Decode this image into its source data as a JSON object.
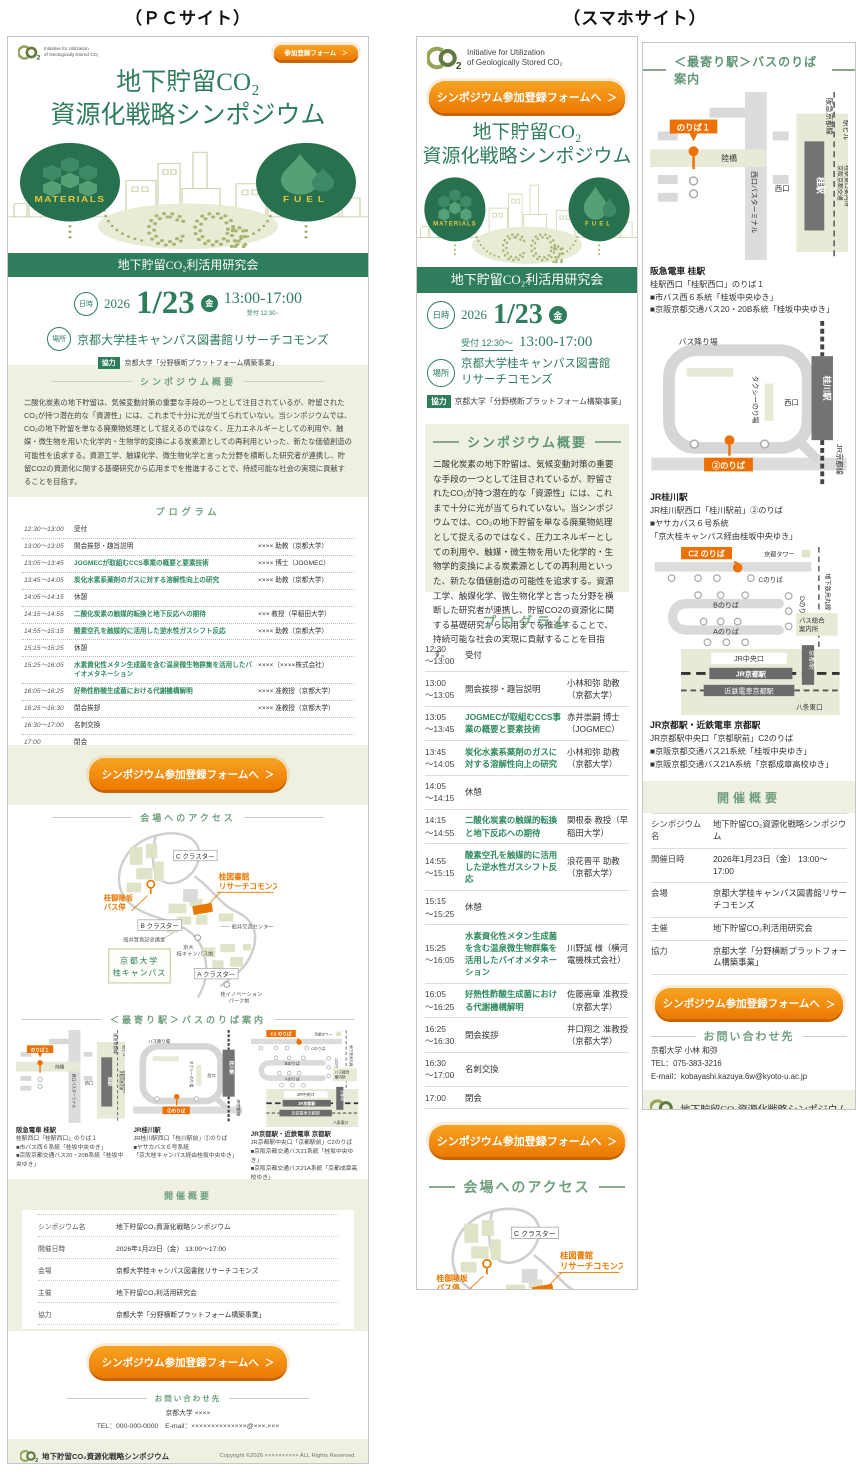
{
  "page": {
    "pc_label": "（ＰＣサイト）",
    "sp_label": "（スマホサイト）"
  },
  "brand": {
    "logo_line1": "Initiative for Utilization",
    "logo_line2": "of Geologically Stored CO₂"
  },
  "hero": {
    "title_line1": "地下貯留CO₂",
    "title_line2": "資源化戦略シンポジウム",
    "materials": "MATERIALS",
    "fuel": "FUEL",
    "co": "CO",
    "two": "2",
    "banner": "地下貯留CO₂利活用研究会"
  },
  "buttons": {
    "register_small": "参加登録フォーム",
    "register_large": "シンポジウム参加登録フォームへ",
    "arrow": "＞"
  },
  "event": {
    "datetime_label": "日時",
    "place_label": "場所",
    "year": "2026",
    "date": "1/23",
    "weekday": "金",
    "time": "13:00-17:00",
    "reception_pc": "受付 12:30−",
    "reception_sp": "受付 12:30～",
    "venue": "京都大学桂キャンパス図書館リサーチコモンズ",
    "venue_sp1": "京都大学桂キャンパス図書館",
    "venue_sp2": "リサーチコモンズ",
    "support_label": "協力",
    "support": "京都大学「分野横断プラットフォーム構築事業」"
  },
  "overview": {
    "heading": "シンポジウム概要",
    "body": "二酸化炭素の地下貯留は、気候変動対策の重要な手段の一つとして注目されているが、貯留されたCO₂が持つ潜在的な「資源性」には、これまで十分に光が当てられていない。当シンポジウムでは、CO₂の地下貯留を単なる廃棄物処理として捉えるのではなく、圧力エネルギーとしての利用や、触媒・微生物を用いた化学的・生物学的変換による炭素源としての再利用といった、新たな価値創造の可能性を追求する。資源工学、触媒化学、微生物化学と言った分野を横断した研究者が連携し、貯留CO2の資源化に関する基礎研究から応用までを推進することで、持続可能な社会の実現に貢献することを目指す。"
  },
  "program": {
    "heading": "プログラム",
    "rows": [
      {
        "t1": "12:30",
        "t2": "～13:00",
        "title": "受付",
        "pc": "",
        "sp": ""
      },
      {
        "t1": "13:00",
        "t2": "～13:05",
        "title": "開会挨拶・趣旨説明",
        "pc": "×××× 助教（京都大学）",
        "sp": "小林和弥 助教（京都大学）"
      },
      {
        "t1": "13:05",
        "t2": "～13:45",
        "title": "JOGMECが取組むCCS事業の概要と要素技術",
        "pc": "×××× 博士（JOGMEC）",
        "sp": "赤井崇嗣 博士（JOGMEC）"
      },
      {
        "t1": "13:45",
        "t2": "～14:05",
        "title": "炭化水素系薬剤のガスに対する溶解性向上の研究",
        "pc": "×××× 助教（京都大学）",
        "sp": "小林和弥 助教（京都大学）"
      },
      {
        "t1": "14:05",
        "t2": "～14:15",
        "title": "休憩",
        "pc": "",
        "sp": ""
      },
      {
        "t1": "14:15",
        "t2": "～14:55",
        "title": "二酸化炭素の触媒的転換と地下反応への期待",
        "pc": "××× 教授（早稲田大学）",
        "sp": "関根泰 教授（早稲田大学）"
      },
      {
        "t1": "14:55",
        "t2": "～15:15",
        "title": "酸素空孔を触媒的に活用した逆水性ガスシフト反応",
        "pc": "×××× 助教（京都大学）",
        "sp": "浪花晋平 助教（京都大学）"
      },
      {
        "t1": "15:15",
        "t2": "～15:25",
        "title": "休憩",
        "pc": "",
        "sp": ""
      },
      {
        "t1": "15:25",
        "t2": "～16:05",
        "title": "水素資化性メタン生成菌を含む温泉微生物群集を活用したバイオメタネーション",
        "pc": "××××（××××株式会社）",
        "sp": "川野誠 様（横河電機株式会社）"
      },
      {
        "t1": "16:05",
        "t2": "～16:25",
        "title": "好熱性酢酸生成菌における代謝機構解明",
        "pc": "×××× 准教授（京都大学）",
        "sp": "佐藤嵩章 准教授（京都大学）"
      },
      {
        "t1": "16:25",
        "t2": "～16:30",
        "title": "閉会挨拶",
        "pc": "×××× 准教授（京都大学）",
        "sp": "井口翔之 准教授（京都大学）"
      },
      {
        "t1": "16:30",
        "t2": "～17:00",
        "title": "名刺交換",
        "pc": "",
        "sp": ""
      },
      {
        "t1": "17:00",
        "t2": "",
        "title": "閉会",
        "pc": "",
        "sp": ""
      }
    ]
  },
  "access": {
    "heading": "会場へのアクセス",
    "labels": {
      "cluster_c": "C クラスター",
      "cluster_b": "B クラスター",
      "cluster_a": "A クラスター",
      "library1": "桂図書館",
      "library2": "リサーチコモンズ",
      "busstop1": "桂御陵坂",
      "busstop2": "バス停",
      "funai_hall": "船井哲良記念講堂",
      "funai_center": "船井交流センター",
      "kyodai1": "京大",
      "kyodai2": "桂キャンパス前",
      "univ1": "京都大学",
      "univ2": "桂キャンパス",
      "innov1": "桂イノベーション",
      "innov2": "パーク前"
    }
  },
  "stations": {
    "heading": "＜最寄り駅＞バスのりば案内",
    "s1": {
      "name": "阪急電車 桂駅",
      "lines": [
        "桂駅西口「桂駅西口」のりば１",
        "■市バス西６系統「桂坂中央ゆき」",
        "■京阪京都交通バス20・20B系統「桂坂中央ゆき」"
      ],
      "map": {
        "noriba": "のりば１",
        "rikkyo": "陸橋",
        "terminal": "西口バスターミナル",
        "hankyu": "阪急京都線",
        "ekibiru": "駅ビル",
        "annai1": "京阪京都交通",
        "annai2": "桂駅東口案内所",
        "nishi": "西口",
        "sta": "桂駅"
      }
    },
    "s2": {
      "name": "JR桂川駅",
      "lines": [
        "JR桂川駅西口「桂川駅前」②のりば",
        "■ヤサカバス６号系統",
        "「京大桂キャンパス経由桂坂中央ゆき」"
      ],
      "map": {
        "oriba": "バス降り場",
        "taxi": "タクシーのり場",
        "nishi": "西口",
        "sta": "桂川駅",
        "jr": "JR京都線",
        "noriba": "②のりば"
      }
    },
    "s3": {
      "name": "JR京都駅・近鉄電車 京都駅",
      "lines": [
        "JR京都駅中央口「京都駅前」C2のりば",
        "■京阪京都交通バス21系統「桂坂中央ゆき」",
        "■京阪京都交通バス21A系統「京都成章高校ゆき」"
      ],
      "map": {
        "c2": "C2 のりば",
        "tower": "京都タワー",
        "c": "Cのりば",
        "subway": "地下鉄烏丸線",
        "d": "Dのりば",
        "b": "Bのりば",
        "info1": "バス総合",
        "info2": "案内所",
        "a": "Aのりば",
        "chuo": "JR中央口",
        "jr": "JR京都駅",
        "kintetsu": "近鉄電車京都駅",
        "sta": "京都駅",
        "hachijo": "八条東口"
      }
    }
  },
  "summary": {
    "heading": "開催概要",
    "rows": [
      {
        "label": "シンポジウム名",
        "value": "地下貯留CO₂資源化戦略シンポジウム"
      },
      {
        "label": "開催日時",
        "value": "2026年1月23日（金） 13:00～17:00"
      },
      {
        "label": "会場",
        "value": "京都大学桂キャンパス図書館リサーチコモンズ"
      },
      {
        "label": "主催",
        "value": "地下貯留CO₂利活用研究会"
      },
      {
        "label": "協力",
        "value": "京都大学「分野横断プラットフォーム構築事業」"
      }
    ]
  },
  "contact": {
    "heading": "お問い合わせ先",
    "pc_name": "京都大学 ××××",
    "pc_telmail": "TEL：000-000-0000　E-mail：××××××××××××××@×××.×××",
    "sp_name": "京都大学 小林 和弥",
    "sp_tel": "TEL：075-383-3216",
    "sp_mail": "E-mail：kobayashi.kazuya.6w@kyoto-u.ac.jp"
  },
  "footer": {
    "site": "地下貯留CO₂資源化戦略シンポジウム",
    "copy_pc": "Copyright ©2026 ×××××××××× ALL Rights Reserved.",
    "copy_sp": "Copyright ©2026 Kobayashi Kazuya ALL Rights Reserved."
  }
}
